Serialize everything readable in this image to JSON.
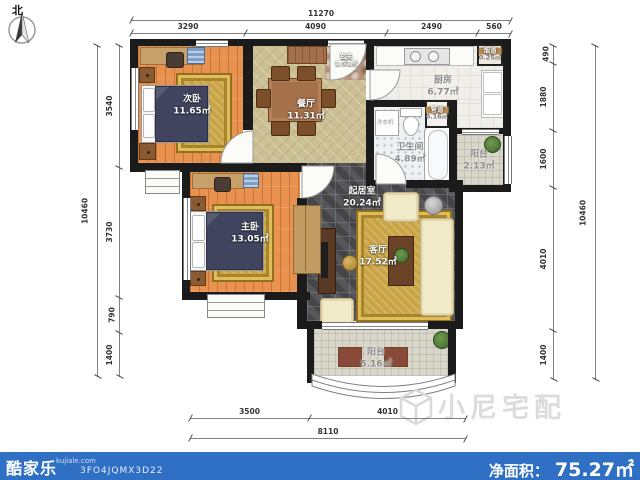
{
  "compass": {
    "north_label": "北"
  },
  "dims": {
    "top_total": "11270",
    "top_segments": [
      "3290",
      "4090",
      "2490",
      "560"
    ],
    "left_total": "10460",
    "left_segments": [
      "3540",
      "3730",
      "790",
      "1400"
    ],
    "right_total": "10460",
    "right_segments": [
      "490",
      "1880",
      "1600",
      "4010",
      "1400"
    ],
    "bottom_total": "8110",
    "bottom_segments": [
      "3500",
      "4010"
    ]
  },
  "rooms": [
    {
      "name": "次卧",
      "area": "11.65㎡"
    },
    {
      "name": "餐厅",
      "area": "11.31㎡"
    },
    {
      "name": "玄关",
      "area": "1.51㎡"
    },
    {
      "name": "厨房",
      "area": "6.77㎡"
    },
    {
      "name": "烟道",
      "area": "0.25㎡"
    },
    {
      "name": "管道",
      "area": "0.16㎡"
    },
    {
      "name": "卫生间",
      "area": "4.89㎡"
    },
    {
      "name": "阳台",
      "area": "2.13㎡"
    },
    {
      "name": "起居室",
      "area": "20.24㎡"
    },
    {
      "name": "主卧",
      "area": "13.05㎡"
    },
    {
      "name": "客厅",
      "area": "17.52㎡"
    },
    {
      "name": "阳台",
      "area": "5.16㎡"
    }
  ],
  "appliances": {
    "washer": "洗衣机"
  },
  "watermark": {
    "text": "小尼宅配"
  },
  "footer": {
    "brand": "酷家乐",
    "domain": "kujiale.com",
    "plan_id": "3FO4JQMX3D22",
    "net_area_label": "净面积：",
    "net_area_value": "75.27㎡"
  },
  "colors": {
    "footer_bar": "#2f6fc4",
    "wall": "#1b1b1b",
    "living_rug": "#c9a445"
  }
}
